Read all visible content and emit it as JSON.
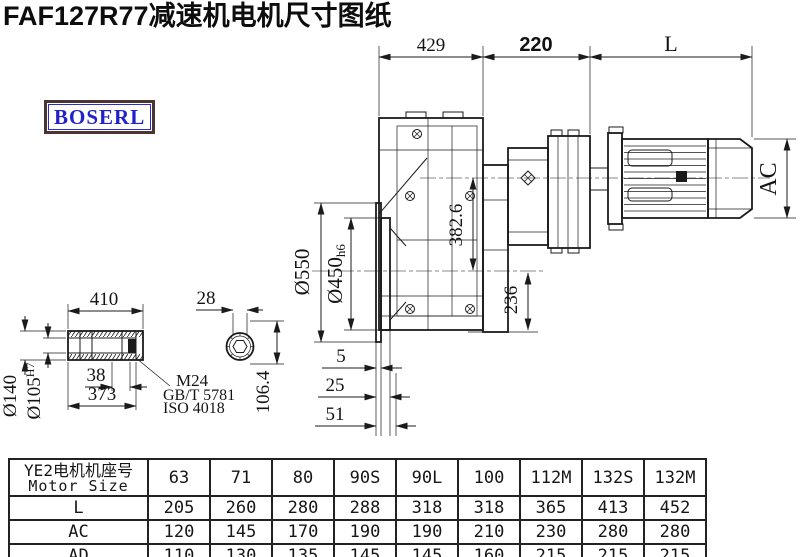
{
  "page": {
    "title": "FAF127R77减速机电机尺寸图纸"
  },
  "brand": {
    "label": "BOSERL"
  },
  "drawing": {
    "top_dims": {
      "gearcase_width": "429",
      "adapter_width": "220",
      "motor_length": "L"
    },
    "main_view": {
      "flange_od": "Ø550",
      "spigot_d": "Ø450",
      "spigot_tol": "h6",
      "input_center": "382.6",
      "base_height": "236",
      "motor_od": "AC",
      "offset_a": "5",
      "offset_b": "25",
      "offset_c": "51"
    },
    "shaft_view": {
      "shaft_len": "410",
      "flat_width": "28",
      "hub_od": "Ø140",
      "bore_d": "Ø105",
      "bore_tol": "H7",
      "collar_len": "38",
      "bore_len": "373",
      "thread": "M24",
      "std_gb": "GB/T 5781",
      "std_iso": "ISO 4018",
      "section_h": "106.4"
    }
  },
  "table": {
    "header_cn": "YE2电机机座号",
    "header_en": "Motor Size",
    "motor_sizes": [
      "63",
      "71",
      "80",
      "90S",
      "90L",
      "100",
      "112M",
      "132S",
      "132M"
    ],
    "rows": [
      {
        "label": "L",
        "values": [
          "205",
          "260",
          "280",
          "288",
          "318",
          "318",
          "365",
          "413",
          "452"
        ]
      },
      {
        "label": "AC",
        "values": [
          "120",
          "145",
          "170",
          "190",
          "190",
          "210",
          "230",
          "280",
          "280"
        ]
      },
      {
        "label": "AD",
        "values": [
          "110",
          "130",
          "135",
          "145",
          "145",
          "160",
          "215",
          "215",
          "215"
        ]
      }
    ]
  }
}
